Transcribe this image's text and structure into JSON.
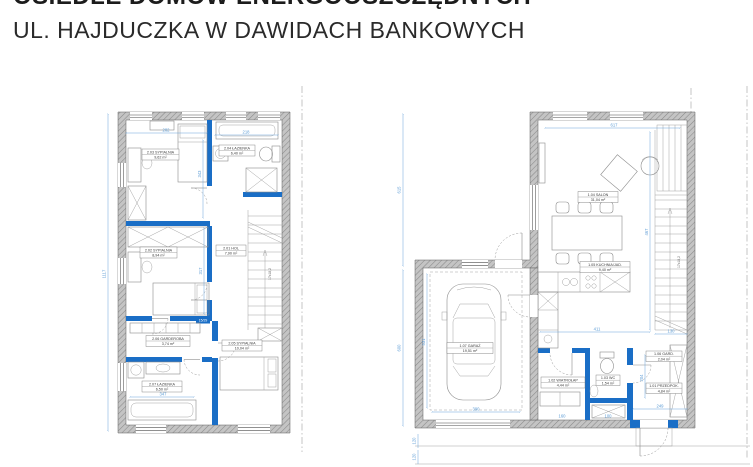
{
  "title": {
    "line1": "OSIEDLE DOMÓW ENERGOOSZCZĘDNYCH",
    "line2": "UL. HAJDUCZKA W DAWIDACH BANKOWYCH"
  },
  "colors": {
    "wall_blue": "#1a6ec6",
    "dim_blue": "#5b9bd5",
    "wall_gray": "#bdbdbd"
  },
  "upper": {
    "bedroom_tl": {
      "tag": "2.03 SYPIALNIA",
      "area": "9,62 m²"
    },
    "bathroom_tr": {
      "tag": "2.04 ŁAZIENKA",
      "area": "6,40 m²"
    },
    "bedroom_mid": {
      "tag": "2.02 SYPIALNIA",
      "area": "8,94 m²"
    },
    "hall": {
      "tag": "2.01 HOL",
      "area": "7,90 m²"
    },
    "wardrobe": {
      "tag": "2.06 GARDEROBA",
      "area": "3,74 m²"
    },
    "bathroom_b": {
      "tag": "2.07 ŁAZIENKA",
      "area": "6,50 m²"
    },
    "bedroom_br": {
      "tag": "2.05 SYPIALNIA",
      "area": "10,04 m²"
    },
    "stairs_note": "17x18,2",
    "wall_tag": "15/29",
    "dims": {
      "total_height": "1117",
      "top_left_width": "282",
      "top_right_width": "218",
      "room_tl_height": "343",
      "room_mid_height": "317",
      "bath_width": "347"
    }
  },
  "ground": {
    "salon": {
      "tag": "1.04 SALON",
      "area": "31,04 m²"
    },
    "kitchen": {
      "tag": "1.05 KUCHNIA/JAD.",
      "area": "9,40 m²"
    },
    "garage": {
      "tag": "1.07 GARAŻ",
      "area": "19,51 m²"
    },
    "vestibule": {
      "tag": "1.02 WIATROŁAP",
      "area": "4,44 m²"
    },
    "wc": {
      "tag": "1.03 WC",
      "area": "1,54 m²"
    },
    "closet": {
      "tag": "1.06 GARD.",
      "area": "2,04 m²"
    },
    "hallway": {
      "tag": "1.01 PRZEDPOK.",
      "area": "4,84 m²"
    },
    "stairs_note": "17x18,2",
    "dims": {
      "top_width": "617",
      "left_upper": "615",
      "left_lower": "600",
      "garage_height": "531",
      "garage_width": "390",
      "kitchen_width": "411",
      "stairs_width": "130",
      "right_height": "467",
      "hall_height": "204",
      "hall_width": "249",
      "vestibule_width": "160",
      "wc_width": "100",
      "step1": "120",
      "step2": "120"
    }
  }
}
